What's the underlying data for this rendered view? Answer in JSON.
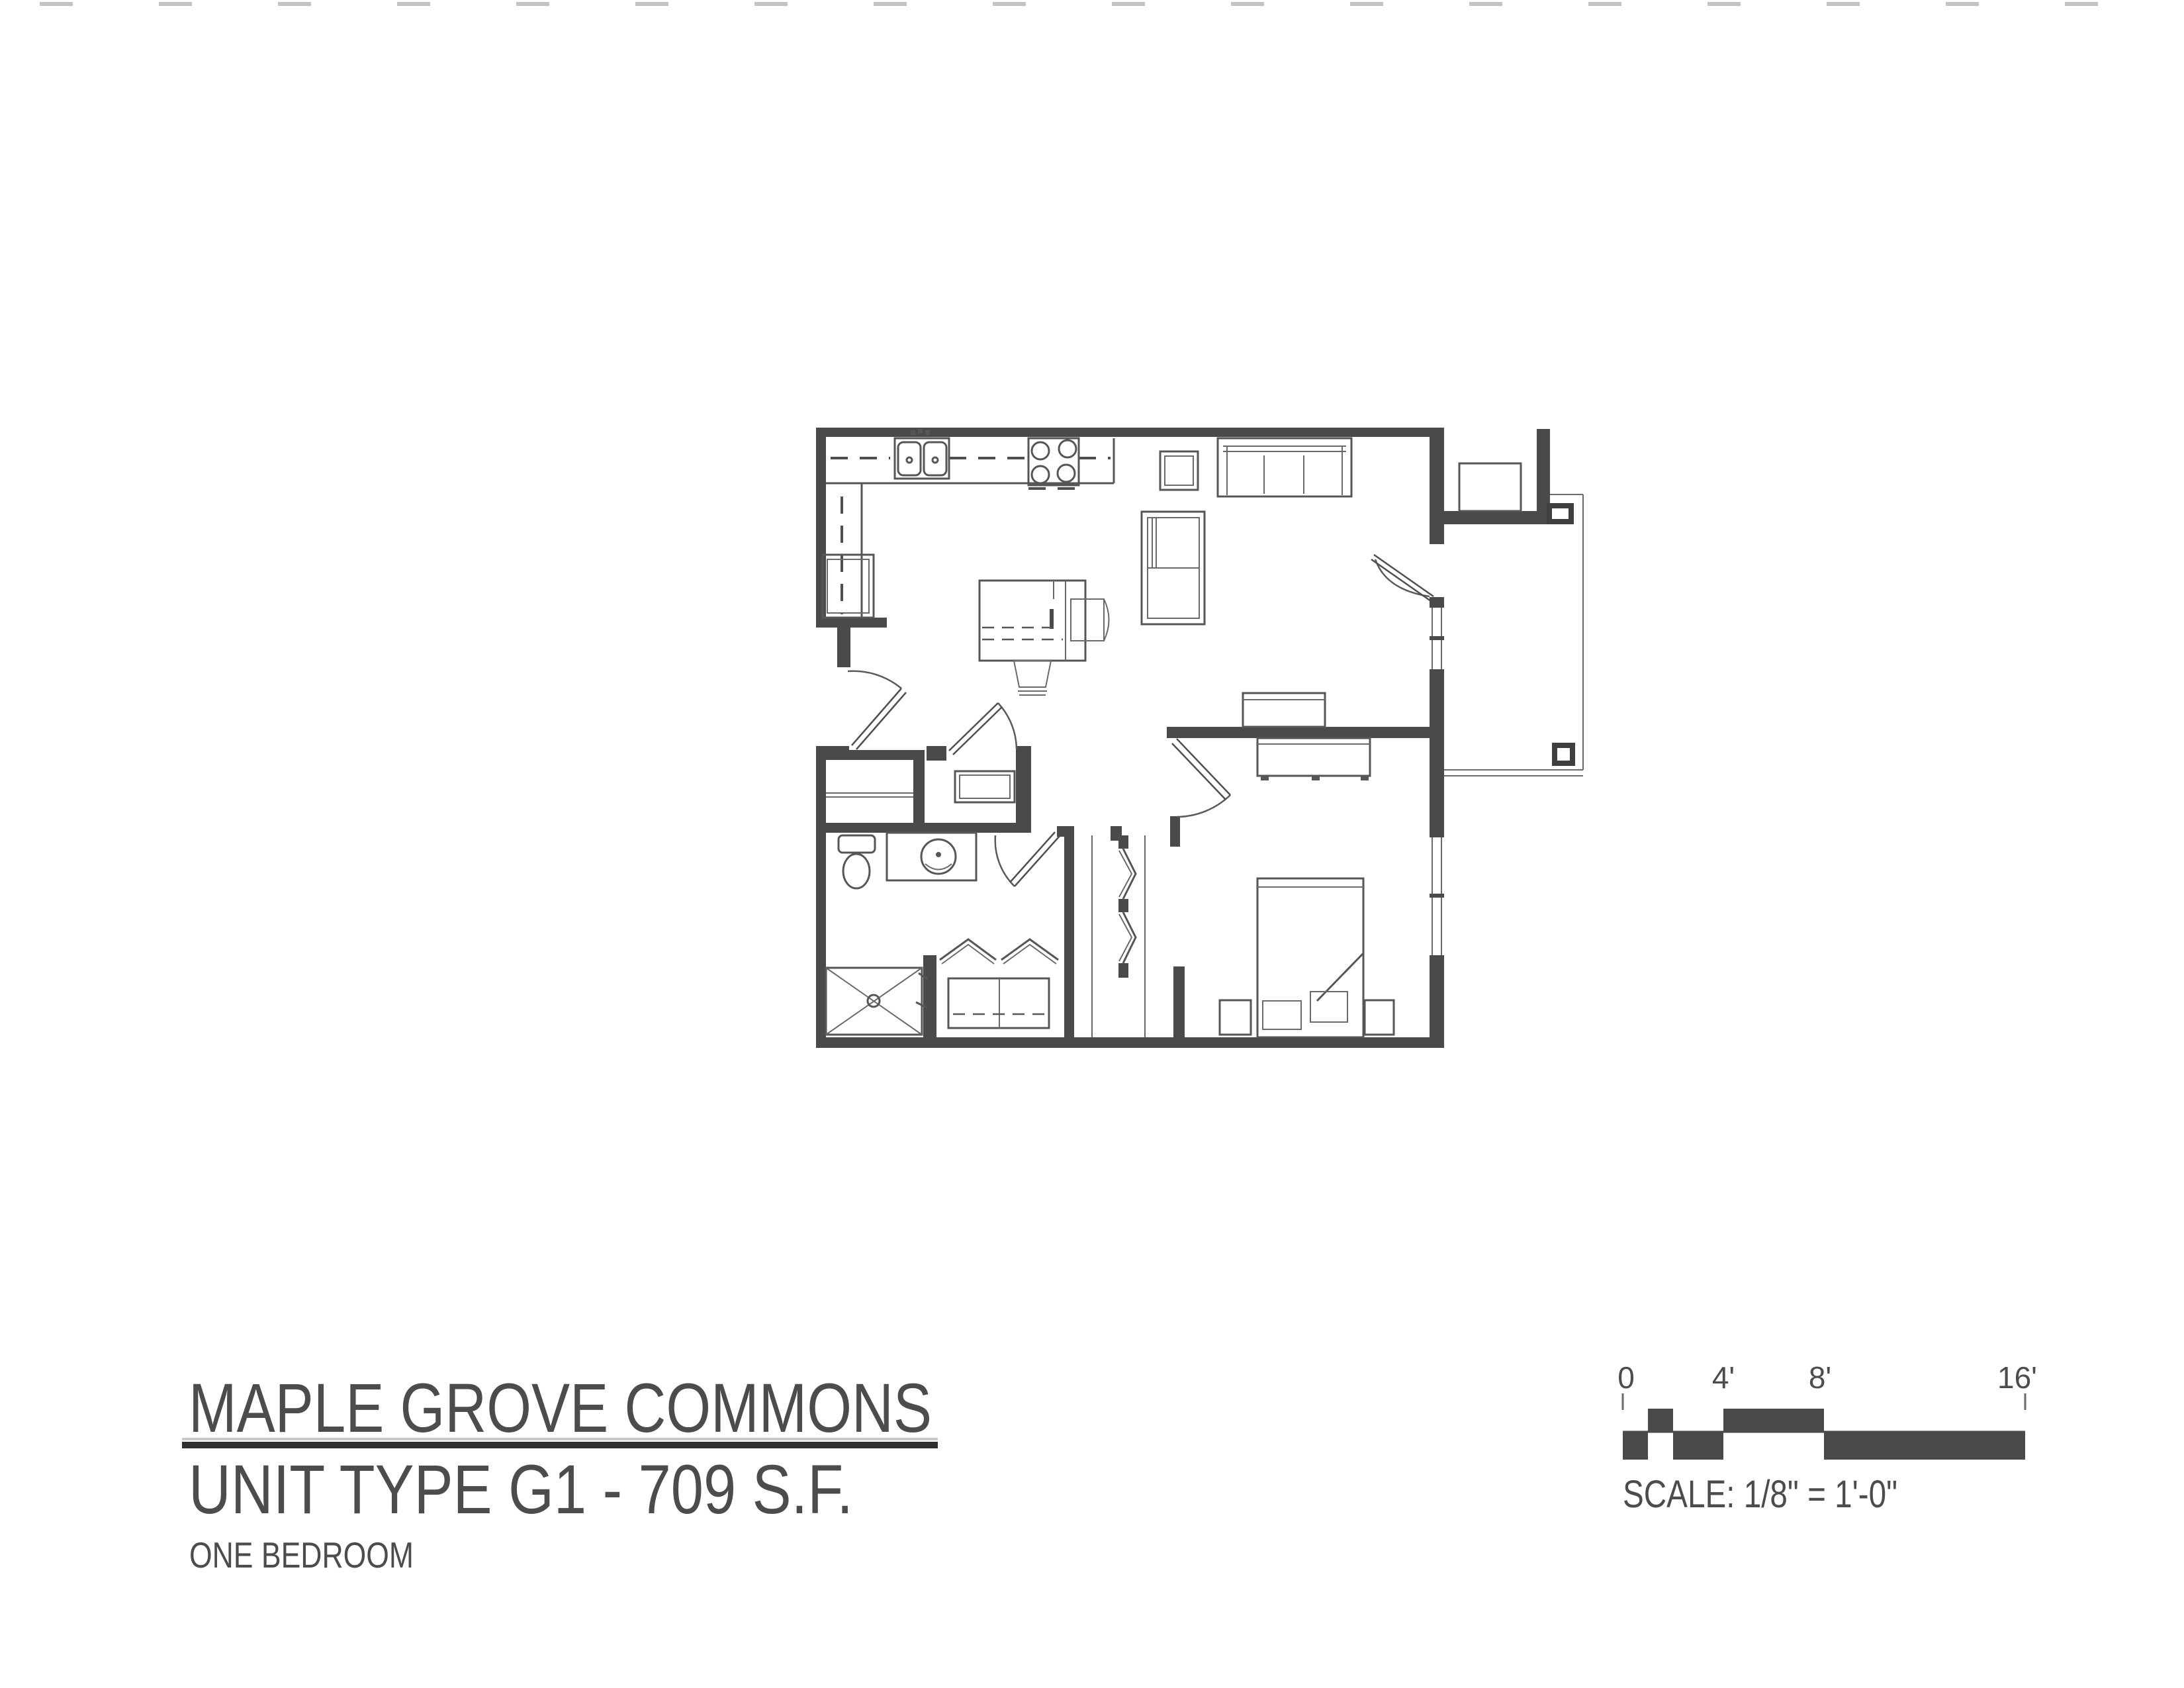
{
  "document": {
    "kind": "architectural-floor-plan-scan",
    "background": "#ffffff"
  },
  "title_block": {
    "project_name": "MAPLE GROVE COMMONS",
    "unit_line": "UNIT TYPE G1 - 709 S.F.",
    "unit_type": "G1",
    "area_sf": 709,
    "subtitle": "ONE BEDROOM"
  },
  "scale_bar": {
    "caption": "SCALE: 1/8\" = 1'-0\"",
    "ticks": [
      "0",
      "4'",
      "8'",
      "16'"
    ],
    "tick_values_feet": [
      0,
      4,
      8,
      16
    ]
  },
  "colors": {
    "wall": "#4a4a4a",
    "furniture_line": "#565656",
    "text": "#4c4c4c",
    "underline": "#2e2e2e"
  },
  "floor_plan": {
    "rooms": [
      "kitchen",
      "dining-area",
      "living-room",
      "bedroom",
      "bathroom",
      "entry-hall",
      "coat-closet",
      "mechanical-closet",
      "linen-closet",
      "bedroom-closet",
      "patio"
    ],
    "fixtures": [
      "double-sink",
      "range-4-burner",
      "refrigerator",
      "dining-table",
      "dining-chair",
      "dining-stool",
      "sofa",
      "shelf-armchair",
      "side-table",
      "media-desk",
      "dresser",
      "bed",
      "nightstand-left",
      "nightstand-right",
      "toilet",
      "vanity-sink",
      "shower-stall",
      "water-heater",
      "entry-bench",
      "patio-column-north",
      "patio-column-south"
    ],
    "doors": [
      "entry-door",
      "mechanical-closet-door",
      "bathroom-door",
      "bedroom-door",
      "patio-door",
      "linen-closet-bifold-doors",
      "bedroom-closet-bifold-doors"
    ],
    "windows": [
      "living-room-window",
      "bedroom-window"
    ]
  }
}
